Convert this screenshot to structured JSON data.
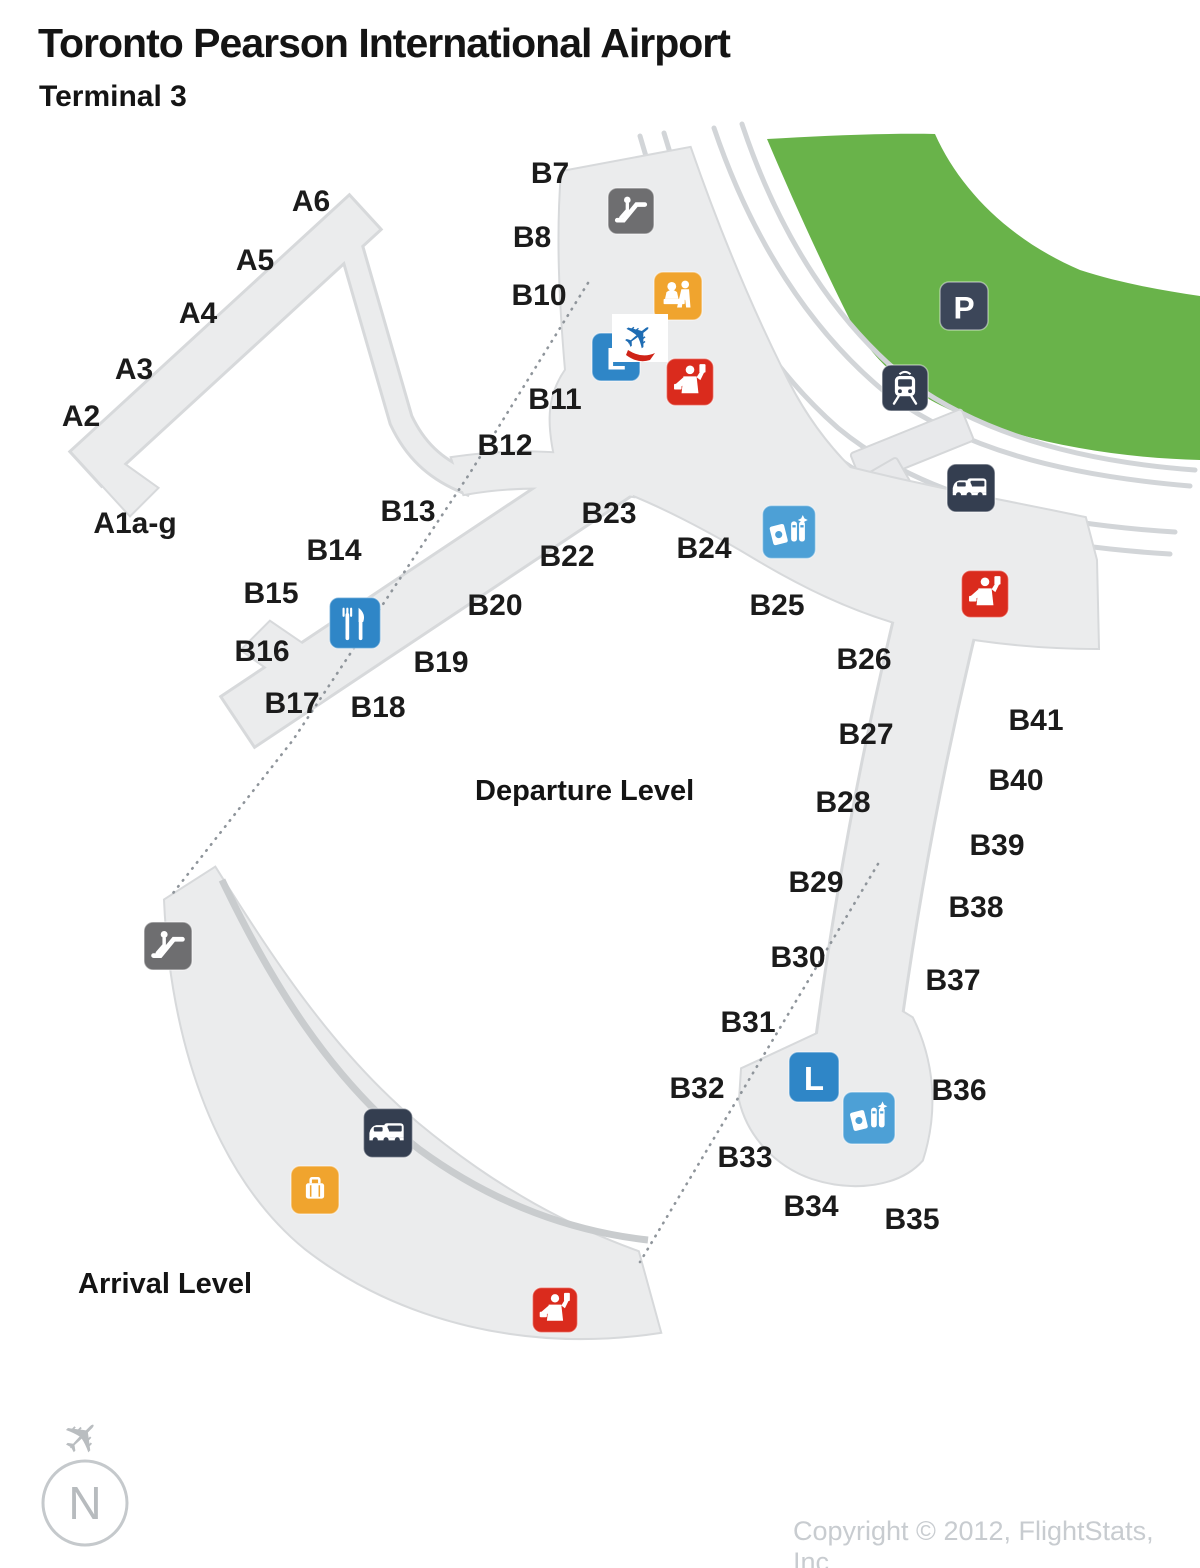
{
  "header": {
    "title": "Toronto Pearson International Airport",
    "subtitle": "Terminal 3"
  },
  "map": {
    "levels": {
      "departure": "Departure Level",
      "arrival": "Arrival Level"
    },
    "compass_label": "N",
    "colors": {
      "green_area": "#69b34a",
      "terminal": "#ebeced",
      "road": "#d2d5d8",
      "icon_gray": "#6e6e70",
      "icon_navy": "#343e50",
      "icon_blue": "#2f86c7",
      "icon_lightblue": "#4da0d6",
      "icon_orange": "#f0a42e",
      "icon_red": "#da2b1d",
      "plane_blue": "#1e6cb3",
      "plane_red": "#cf2317"
    },
    "gate_labels_a": [
      {
        "label": "A6",
        "x": 311,
        "y": 211
      },
      {
        "label": "A5",
        "x": 255,
        "y": 270
      },
      {
        "label": "A4",
        "x": 198,
        "y": 323
      },
      {
        "label": "A3",
        "x": 134,
        "y": 379
      },
      {
        "label": "A2",
        "x": 81,
        "y": 426
      },
      {
        "label": "A1a-g",
        "x": 135,
        "y": 533
      }
    ],
    "gate_labels_b": [
      {
        "label": "B7",
        "x": 550,
        "y": 183
      },
      {
        "label": "B8",
        "x": 532,
        "y": 247
      },
      {
        "label": "B10",
        "x": 539,
        "y": 305
      },
      {
        "label": "B11",
        "x": 555,
        "y": 409
      },
      {
        "label": "B12",
        "x": 505,
        "y": 455
      },
      {
        "label": "B13",
        "x": 408,
        "y": 521
      },
      {
        "label": "B14",
        "x": 334,
        "y": 560
      },
      {
        "label": "B15",
        "x": 271,
        "y": 603
      },
      {
        "label": "B16",
        "x": 262,
        "y": 661
      },
      {
        "label": "B17",
        "x": 292,
        "y": 713
      },
      {
        "label": "B18",
        "x": 378,
        "y": 717
      },
      {
        "label": "B19",
        "x": 441,
        "y": 672
      },
      {
        "label": "B20",
        "x": 495,
        "y": 615
      },
      {
        "label": "B22",
        "x": 567,
        "y": 566
      },
      {
        "label": "B23",
        "x": 609,
        "y": 523
      },
      {
        "label": "B24",
        "x": 704,
        "y": 558
      },
      {
        "label": "B25",
        "x": 777,
        "y": 615
      },
      {
        "label": "B26",
        "x": 864,
        "y": 669
      },
      {
        "label": "B27",
        "x": 866,
        "y": 744
      },
      {
        "label": "B28",
        "x": 843,
        "y": 812
      },
      {
        "label": "B29",
        "x": 816,
        "y": 892
      },
      {
        "label": "B30",
        "x": 798,
        "y": 967
      },
      {
        "label": "B31",
        "x": 748,
        "y": 1032
      },
      {
        "label": "B32",
        "x": 697,
        "y": 1098
      },
      {
        "label": "B33",
        "x": 745,
        "y": 1167
      },
      {
        "label": "B34",
        "x": 811,
        "y": 1216
      },
      {
        "label": "B35",
        "x": 912,
        "y": 1229
      },
      {
        "label": "B36",
        "x": 959,
        "y": 1100
      },
      {
        "label": "B37",
        "x": 953,
        "y": 990
      },
      {
        "label": "B38",
        "x": 976,
        "y": 917
      },
      {
        "label": "B39",
        "x": 997,
        "y": 855
      },
      {
        "label": "B40",
        "x": 1016,
        "y": 790
      },
      {
        "label": "B41",
        "x": 1036,
        "y": 730
      }
    ],
    "icons": [
      {
        "name": "escalator-icon",
        "glyph": "escalator",
        "x": 631,
        "y": 211,
        "s": 46,
        "color": "#6e6e70"
      },
      {
        "name": "check-in-desk-icon",
        "glyph": "checkin",
        "x": 678,
        "y": 296,
        "s": 48,
        "color": "#f0a42e"
      },
      {
        "name": "elevator-icon",
        "glyph": "elevator",
        "letter": "L",
        "x": 616,
        "y": 357,
        "s": 48,
        "color": "#2f86c7"
      },
      {
        "name": "passport-control-icon",
        "glyph": "customs",
        "x": 690,
        "y": 382,
        "s": 47,
        "color": "#da2b1d"
      },
      {
        "name": "parking-icon",
        "glyph": "parking",
        "letter": "P",
        "x": 964,
        "y": 306,
        "s": 48,
        "color": "#3c4659"
      },
      {
        "name": "train-station-icon",
        "glyph": "train",
        "x": 905,
        "y": 388,
        "s": 46,
        "color": "#343e50"
      },
      {
        "name": "ground-transport-icon",
        "glyph": "taxi",
        "x": 971,
        "y": 488,
        "s": 48,
        "color": "#343e50"
      },
      {
        "name": "currency-exchange-icon",
        "glyph": "currency",
        "x": 789,
        "y": 532,
        "s": 53,
        "color": "#4da0d6"
      },
      {
        "name": "passport-control-icon",
        "glyph": "customs",
        "x": 985,
        "y": 594,
        "s": 47,
        "color": "#da2b1d"
      },
      {
        "name": "restaurant-icon",
        "glyph": "restaurant",
        "x": 355,
        "y": 623,
        "s": 51,
        "color": "#2f86c7"
      },
      {
        "name": "escalator-icon",
        "glyph": "escalator",
        "x": 168,
        "y": 946,
        "s": 48,
        "color": "#6e6e70"
      },
      {
        "name": "ground-transport-icon",
        "glyph": "taxi",
        "x": 388,
        "y": 1133,
        "s": 49,
        "color": "#343e50"
      },
      {
        "name": "baggage-claim-icon",
        "glyph": "baggage",
        "x": 315,
        "y": 1190,
        "s": 48,
        "color": "#f0a42e"
      },
      {
        "name": "elevator-icon",
        "glyph": "elevator",
        "letter": "L",
        "x": 814,
        "y": 1077,
        "s": 50,
        "color": "#2f86c7"
      },
      {
        "name": "currency-exchange-icon",
        "glyph": "currency",
        "x": 869,
        "y": 1118,
        "s": 52,
        "color": "#4da0d6"
      },
      {
        "name": "passport-control-icon",
        "glyph": "customs",
        "x": 555,
        "y": 1310,
        "s": 45,
        "color": "#da2b1d"
      }
    ]
  },
  "footer": {
    "copyright": "Copyright © 2012, FlightStats, Inc."
  }
}
